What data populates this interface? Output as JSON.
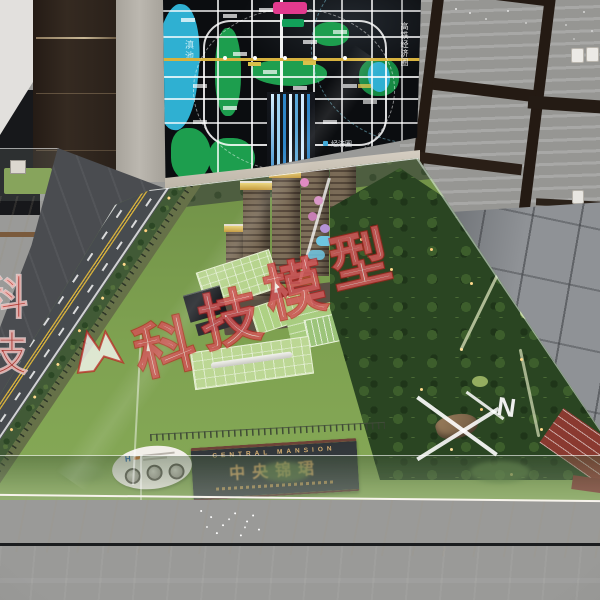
{
  "photo": {
    "map_board": {
      "lake_label": "滇池",
      "rail_zone_label": "高铁经济圈",
      "econ_zone_label": "经济圈"
    },
    "model": {
      "sign": {
        "title_en": "CENTRAL MANSION",
        "title_cn": "中央锦珺"
      },
      "plate_logo": "H"
    },
    "watermark": {
      "chars": [
        "科",
        "技",
        "模",
        "型"
      ],
      "edge_chars": [
        "科",
        "技"
      ],
      "compass_letter": "N",
      "outline_color": "#c22a22",
      "fill_color": "#ffffff"
    },
    "palette": {
      "wall": "#c7c3bd",
      "wood": "#2f251e",
      "board_bg": "#0b0d10",
      "map_green": "#1d9e4e",
      "lake_blue": "#2fb0d2",
      "lawn_green": "#7fa251",
      "forest_green": "#2a4522",
      "road_asphalt": "#45494d",
      "marble_light": "#e9e3d8",
      "marble_dark": "#3c3e42",
      "gold": "#c9a065",
      "badge_pink": "#e23a8e"
    }
  }
}
